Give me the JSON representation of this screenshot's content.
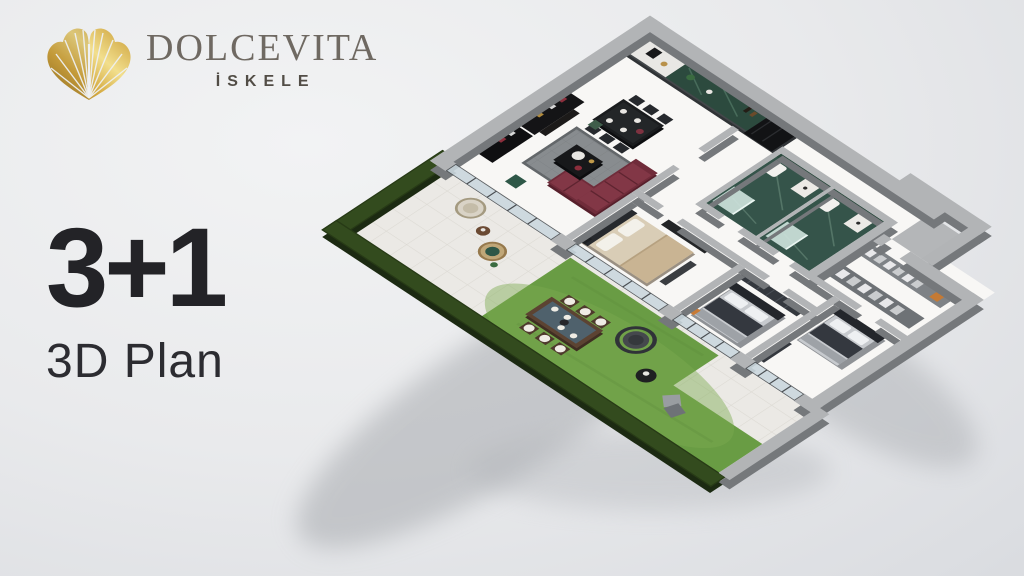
{
  "brand": {
    "name": "DOLCEVITA",
    "location": "İSKELE",
    "icon": "gold-fan-leaf-icon"
  },
  "headline": {
    "unit": "3+1",
    "caption": "3D Plan"
  },
  "colors": {
    "background_light": "#f2f3f4",
    "background_dark": "#cfd2d7",
    "brand_text": "#6f6962",
    "brand_sub_text": "#524d46",
    "gold_dark": "#8f6b22",
    "gold_mid": "#d4a940",
    "gold_light": "#f2df8d",
    "headline_text": "#232327",
    "wall_top": "#b2b4b6",
    "wall_side": "#75787b",
    "interior_floor": "#f8f7f5",
    "patio_tile": "#ebe9e5",
    "grass": "#699c44",
    "hedge": "#334b1e",
    "sofa_burgundy": "#823746",
    "kitchen_marble_green": "#2c4a3e",
    "bathroom_marble_green": "#35544a",
    "bed_beige": "#d9cdb6",
    "bedding_gray": "#c7cace",
    "garden_wood": "#5c4332"
  },
  "floorplan": {
    "view": "isometric-3d-apartment-plan",
    "unit_type": "3+1",
    "rooms": [
      "kitchen",
      "living-room",
      "bathroom-1",
      "bathroom-2",
      "hallway",
      "master-bedroom",
      "bedroom-2",
      "bedroom-3",
      "walk-in-closet",
      "entry-porch",
      "patio",
      "garden"
    ]
  }
}
